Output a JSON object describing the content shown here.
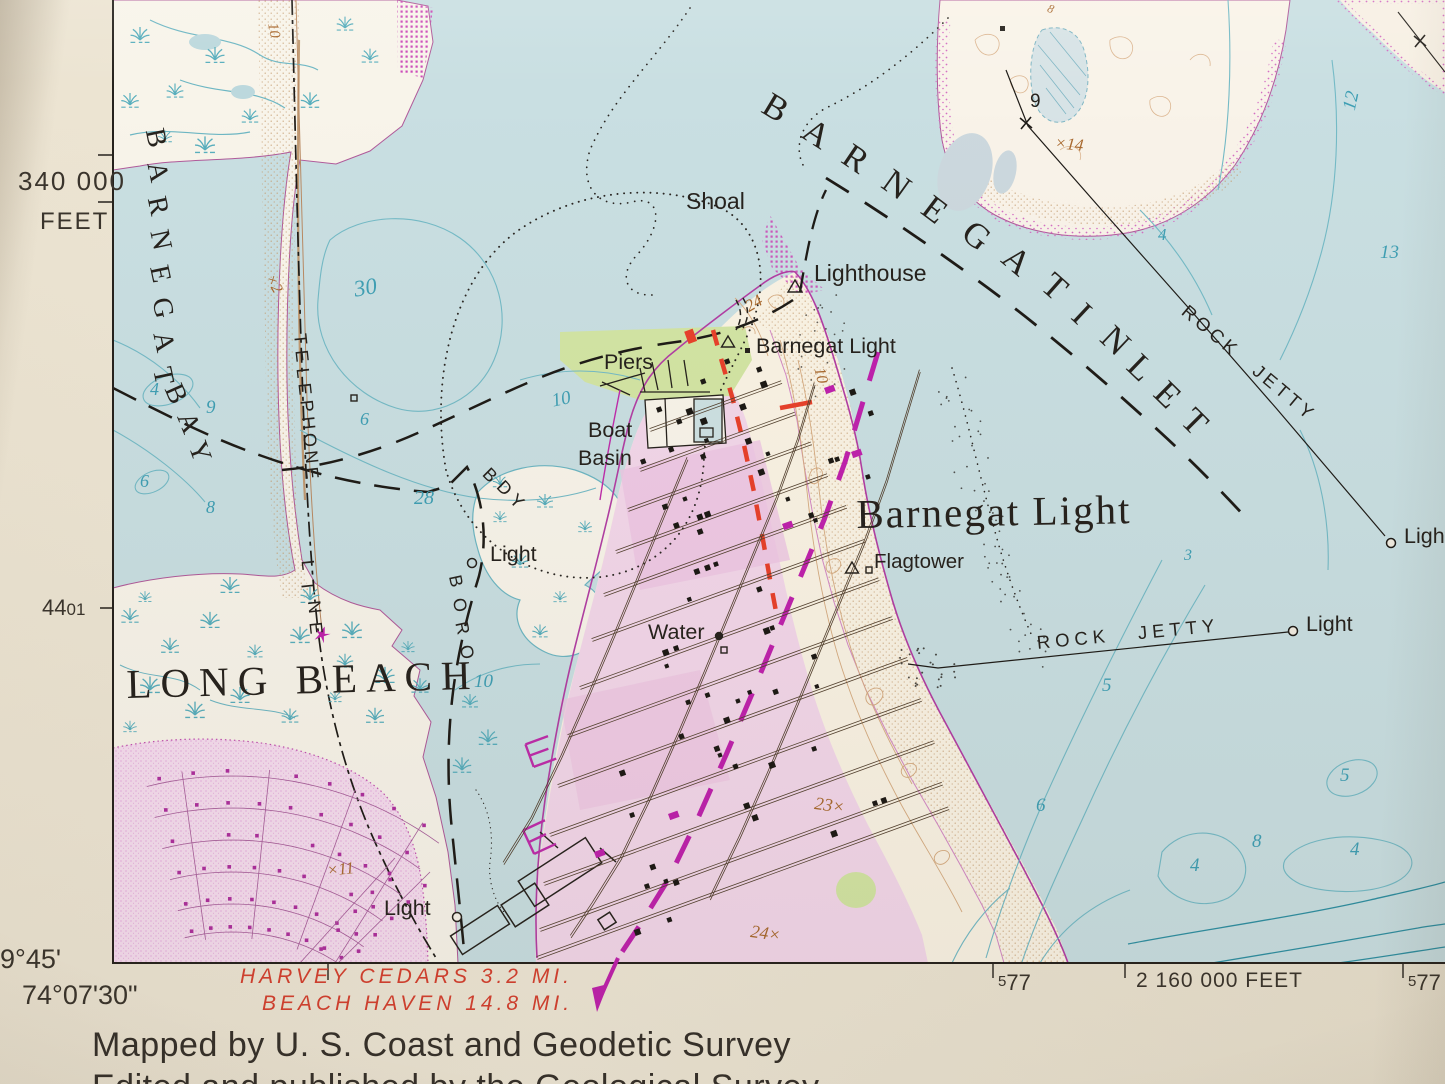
{
  "margin": {
    "grid_y_value": "340 000",
    "grid_y_unit": "FEET",
    "grid_y2_big": "44",
    "grid_y2_small": "01",
    "lat_label": "9°45'",
    "lon_label": "74°07'30\"",
    "grid_x1_sup": "5",
    "grid_x1_main": "77",
    "grid_x2_label": "2 160 000 FEET",
    "grid_x3_sup": "5",
    "grid_x3_main": "77",
    "dest_line1": "HARVEY CEDARS 3.2 MI.",
    "dest_line2": "BEACH HAVEN 14.8 MI.",
    "credit_line1": "Mapped by U. S. Coast and Geodetic Survey",
    "credit_line2": "Edited and published by the Geological Survey"
  },
  "water": {
    "bay_word1": "BARNEGAT",
    "bay_word2": "BAY",
    "inlet_word1": "BARNEGAT",
    "inlet_word2": "INLET",
    "shoal": "Shoal",
    "depths": {
      "d30": "30",
      "d28": "28",
      "d9": "9",
      "d4a": "4",
      "d6a": "6",
      "d6b": "6",
      "d8a": "8",
      "d10a": "10",
      "d10b": "10",
      "d12": "12",
      "d13": "13",
      "d4b": "4",
      "d3": "3",
      "d5a": "5",
      "d5b": "5",
      "d6c": "6",
      "d4c": "4",
      "d8b": "8",
      "d4d": "4"
    }
  },
  "places": {
    "town": "Barnegat Light",
    "long_beach": "LONG BEACH",
    "lighthouse": "Lighthouse",
    "station": "Barnegat Light",
    "piers": "Piers",
    "boat": "Boat",
    "basin": "Basin",
    "flagtower": "Flagtower",
    "water_tank": "Water",
    "light": "Light",
    "rock_jetty": "ROCK JETTY",
    "telephone": "TELEPHONE",
    "line": "LINE",
    "boro": "BORO",
    "bdy": "BDY"
  },
  "elevations": {
    "e14": "×14",
    "e2": "×2",
    "e11": "×11",
    "e23": "23×",
    "e24": "24×",
    "c24": "24",
    "c10": "10",
    "c10b": "10",
    "c8": "8",
    "j9": "9"
  },
  "colors": {
    "water": "#c9dfe2",
    "land": "#f8f4ea",
    "town_pink": "#f3d7ea",
    "magenta": "#bf21ad",
    "red_road": "#e8412b",
    "red_text": "#d6402f",
    "teal": "#3f9fb4",
    "brown": "#a96a30",
    "ink": "#26221d"
  }
}
